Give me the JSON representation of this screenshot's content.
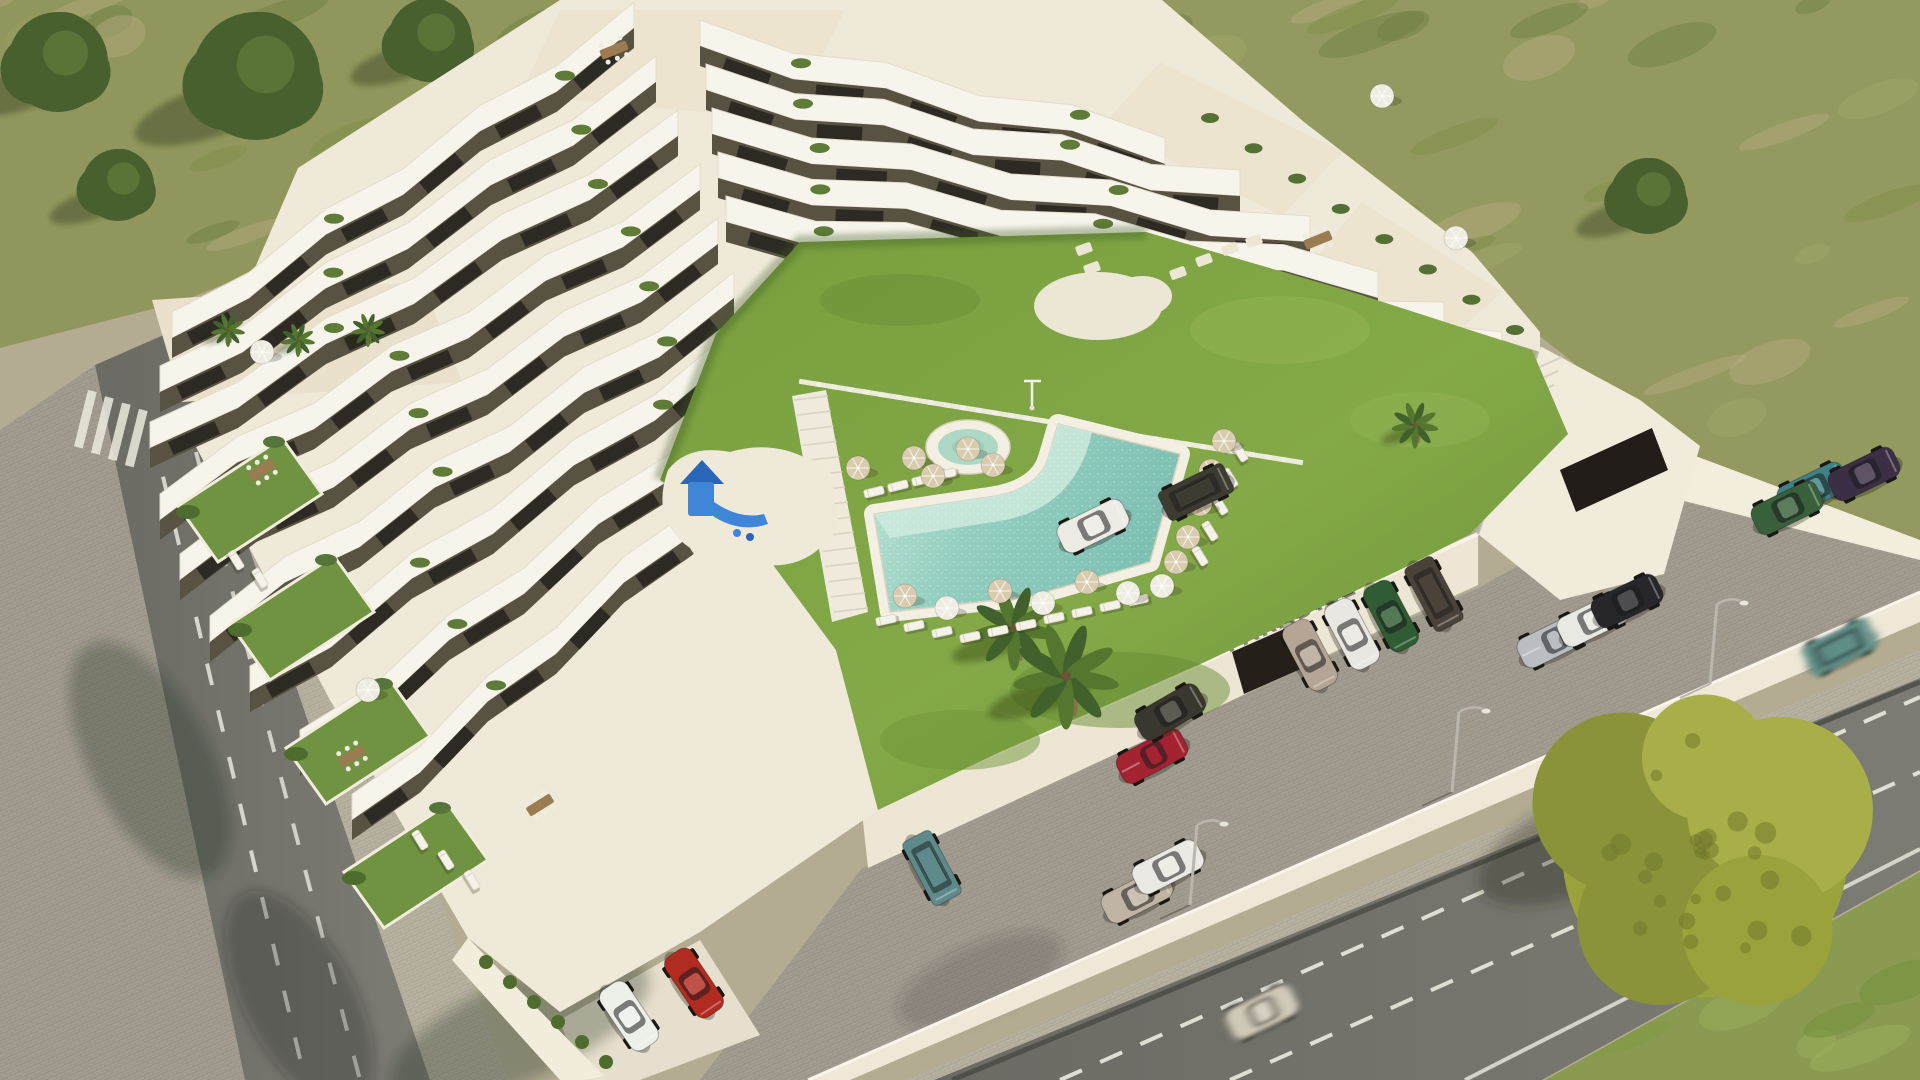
{
  "meta": {
    "kind": "aerial-architectural-render",
    "subject": "Terraced white apartment complex with courtyard pool, lawn, playground and parking"
  },
  "sign": {
    "text_main": "PARADISE",
    "text_script": "Resort",
    "color": "#35312a"
  },
  "palette": {
    "building_white": "#f7f4ec",
    "facade_dark": "#585242",
    "window": "#2d2a23",
    "lawn": "#7da244",
    "pool_water": "#8fcabe",
    "pool_shallow": "#c9e9da",
    "umbrella_tan": "#d9cbad",
    "umbrella_white": "#efece1",
    "asphalt": "#74746c",
    "cobble": "#a39d91",
    "field": "#949a5f",
    "yellow_tree": "#9aa23c"
  },
  "scene": {
    "cars": [
      {
        "x": 1310,
        "y": 655,
        "a": 62,
        "c": "#b5a595",
        "k": "hatch"
      },
      {
        "x": 1352,
        "y": 634,
        "a": 62,
        "c": "#e9e7e1",
        "k": "sedan"
      },
      {
        "x": 1391,
        "y": 616,
        "a": 62,
        "c": "#2f5c33",
        "k": "hatch"
      },
      {
        "x": 1434,
        "y": 594,
        "a": 62,
        "c": "#4b4339",
        "k": "gwagon"
      },
      {
        "x": 1093,
        "y": 526,
        "a": -26,
        "c": "#edebe5",
        "k": "sedan"
      },
      {
        "x": 1196,
        "y": 492,
        "a": -26,
        "c": "#3e3b32",
        "k": "gwagon"
      },
      {
        "x": 1152,
        "y": 756,
        "a": -28,
        "c": "#a32330",
        "k": "sport"
      },
      {
        "x": 1170,
        "y": 712,
        "a": -30,
        "c": "#3a372f",
        "k": "suv"
      },
      {
        "x": 932,
        "y": 868,
        "a": 62,
        "c": "#5f8a8b",
        "k": "gwagon"
      },
      {
        "x": 1137,
        "y": 896,
        "a": -27,
        "c": "#c0b5a4",
        "k": "hatch"
      },
      {
        "x": 1168,
        "y": 867,
        "a": -27,
        "c": "#eae8e2",
        "k": "hatch"
      },
      {
        "x": 629,
        "y": 1016,
        "a": 56,
        "c": "#edefe9",
        "k": "sedan"
      },
      {
        "x": 694,
        "y": 983,
        "a": 56,
        "c": "#b12b21",
        "k": "hatch"
      },
      {
        "x": 1553,
        "y": 641,
        "a": -26,
        "c": "#babdc1",
        "k": "sport"
      },
      {
        "x": 1593,
        "y": 620,
        "a": -26,
        "c": "#e9e9e4",
        "k": "hatch"
      },
      {
        "x": 1627,
        "y": 601,
        "a": -26,
        "c": "#27272b",
        "k": "sedan"
      },
      {
        "x": 1813,
        "y": 489,
        "a": -26,
        "c": "#408086",
        "k": "hatch"
      },
      {
        "x": 1787,
        "y": 508,
        "a": -26,
        "c": "#38613b",
        "k": "hatch"
      },
      {
        "x": 1864,
        "y": 474,
        "a": -26,
        "c": "#3b2f45",
        "k": "sedan"
      },
      {
        "x": 1262,
        "y": 1012,
        "a": -26,
        "c": "#d0c9b7",
        "k": "sedan",
        "blur": true
      },
      {
        "x": 1840,
        "y": 647,
        "a": -26,
        "c": "#5e8e87",
        "k": "gwagon",
        "blur": true
      }
    ],
    "umbrellas": [
      [
        858,
        468,
        "t"
      ],
      [
        914,
        458,
        "t"
      ],
      [
        968,
        449,
        "t"
      ],
      [
        933,
        476,
        "t"
      ],
      [
        993,
        465,
        "t"
      ],
      [
        905,
        596,
        "t"
      ],
      [
        947,
        608,
        "w"
      ],
      [
        1000,
        591,
        "t"
      ],
      [
        1043,
        603,
        "w"
      ],
      [
        1087,
        582,
        "t"
      ],
      [
        1128,
        593,
        "w"
      ],
      [
        1162,
        586,
        "w"
      ],
      [
        1224,
        441,
        "t"
      ],
      [
        1211,
        471,
        "t"
      ],
      [
        1200,
        504,
        "t"
      ],
      [
        1188,
        537,
        "t"
      ],
      [
        1176,
        562,
        "t"
      ],
      [
        1382,
        96,
        "w"
      ],
      [
        1456,
        238,
        "w"
      ],
      [
        262,
        352,
        "w"
      ],
      [
        368,
        690,
        "w"
      ]
    ],
    "loungers": [
      [
        874,
        492,
        -14
      ],
      [
        898,
        486,
        -14
      ],
      [
        922,
        480,
        -14
      ],
      [
        946,
        474,
        -14
      ],
      [
        886,
        620,
        -12
      ],
      [
        914,
        626,
        -12
      ],
      [
        942,
        632,
        -12
      ],
      [
        970,
        637,
        -12
      ],
      [
        998,
        631,
        -12
      ],
      [
        1026,
        625,
        -12
      ],
      [
        1054,
        618,
        -12
      ],
      [
        1082,
        612,
        -12
      ],
      [
        1110,
        606,
        -12
      ],
      [
        1138,
        600,
        -12
      ],
      [
        1240,
        452,
        58
      ],
      [
        1230,
        478,
        58
      ],
      [
        1220,
        505,
        58
      ],
      [
        1210,
        531,
        58
      ],
      [
        1200,
        556,
        58
      ],
      [
        420,
        840,
        58
      ],
      [
        446,
        860,
        58
      ],
      [
        472,
        880,
        58
      ],
      [
        236,
        560,
        58
      ],
      [
        260,
        578,
        58
      ]
    ],
    "tables": [
      [
        352,
        756,
        -32
      ],
      [
        540,
        805,
        -32
      ],
      [
        262,
        470,
        -32
      ],
      [
        1318,
        240,
        -22
      ],
      [
        614,
        50,
        -22
      ]
    ],
    "lamps": [
      [
        1190,
        905
      ],
      [
        1452,
        792
      ],
      [
        1710,
        684
      ]
    ],
    "trees": [
      [
        58,
        62,
        50
      ],
      [
        256,
        76,
        64
      ],
      [
        430,
        40,
        42
      ],
      [
        118,
        185,
        36
      ],
      [
        1648,
        196,
        38
      ]
    ],
    "yellow_tree": {
      "x": 1705,
      "y": 855,
      "r": 150
    },
    "palms": [
      [
        1014,
        628,
        40
      ],
      [
        1066,
        676,
        50
      ],
      [
        1415,
        425,
        22
      ]
    ],
    "roof_palms": [
      [
        228,
        330,
        16
      ],
      [
        298,
        340,
        16
      ],
      [
        368,
        330,
        16
      ]
    ],
    "stones": [
      [
        1152,
        287
      ],
      [
        1178,
        273
      ],
      [
        1204,
        260
      ],
      [
        1230,
        249
      ],
      [
        1254,
        241
      ],
      [
        1092,
        268
      ],
      [
        1084,
        249
      ]
    ],
    "hedge_wall_dots": [
      [
        486,
        962
      ],
      [
        510,
        982
      ],
      [
        534,
        1002
      ],
      [
        558,
        1022
      ],
      [
        582,
        1042
      ],
      [
        606,
        1062
      ]
    ],
    "gardens": [
      [
        250,
        500
      ],
      [
        302,
        618
      ],
      [
        358,
        742
      ],
      [
        416,
        866
      ]
    ],
    "slat_path": {
      "x1": 810,
      "y1": 383,
      "x2": 1292,
      "y2": 461,
      "n": 30
    },
    "bands_left": [
      [
        634,
        8,
        172,
        318
      ],
      [
        656,
        62,
        160,
        372
      ],
      [
        678,
        116,
        150,
        428
      ],
      [
        700,
        170,
        160,
        488
      ],
      [
        718,
        224,
        180,
        548
      ],
      [
        734,
        278,
        210,
        610
      ],
      [
        736,
        332,
        250,
        672
      ],
      [
        748,
        388,
        300,
        736
      ],
      [
        760,
        444,
        352,
        800
      ]
    ],
    "bands_right": [
      [
        700,
        26,
        1165,
        132
      ],
      [
        706,
        70,
        1240,
        176
      ],
      [
        712,
        114,
        1310,
        222
      ],
      [
        718,
        158,
        1378,
        266
      ],
      [
        726,
        202,
        1444,
        308
      ],
      [
        1160,
        252,
        1502,
        338
      ],
      [
        1282,
        298,
        1526,
        356
      ]
    ],
    "spa": {
      "x": 968,
      "y": 447
    },
    "shower": {
      "x": 1032,
      "y": 394
    },
    "playground": {
      "x": 700,
      "y": 498
    }
  }
}
